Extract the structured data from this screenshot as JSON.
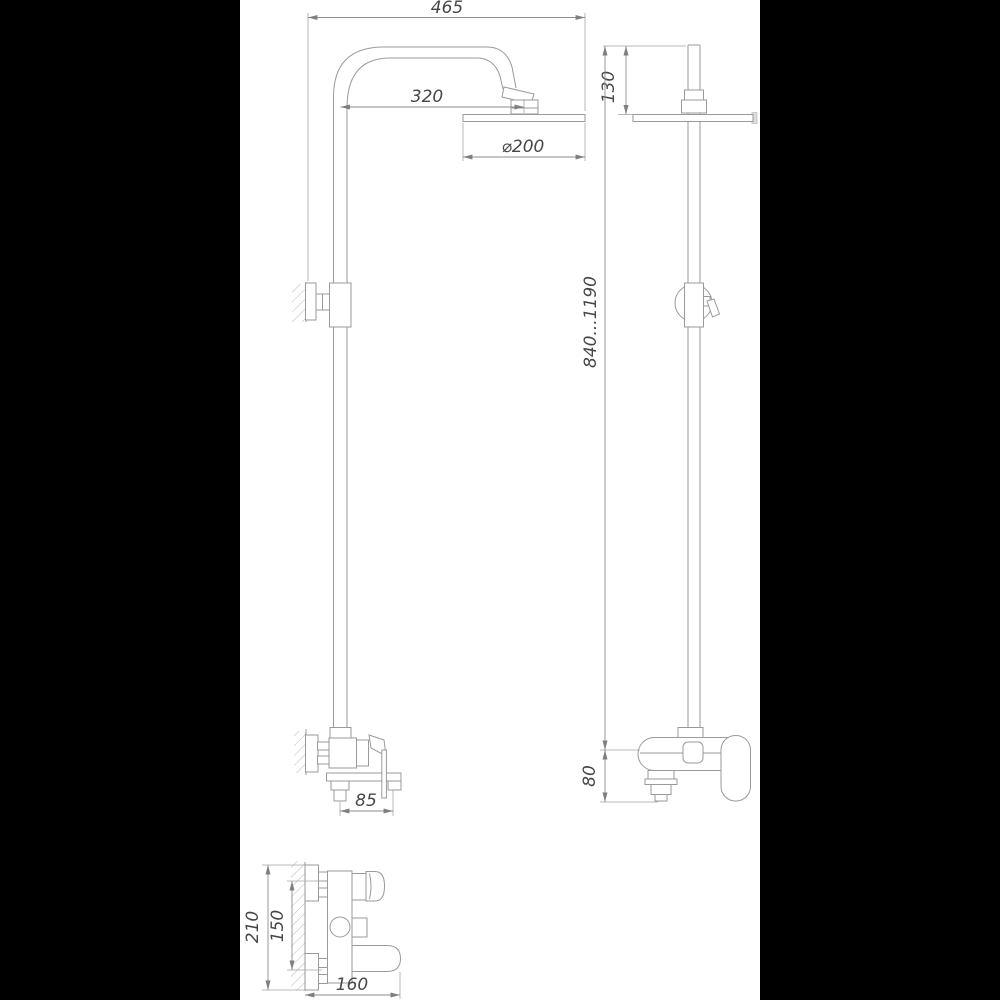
{
  "drawing": {
    "kind": "technical-dimension-drawing",
    "subject": "shower-column-with-rain-head-and-wall-mixer",
    "colors": {
      "line": "#9a9a9a",
      "text": "#474747",
      "sheet_background": "#ffffff",
      "matte_background": "#000000"
    },
    "dims": {
      "d465": "465",
      "d320": "320",
      "d200": "⌀200",
      "d130": "130",
      "d840_1190": "840...1190",
      "d80": "80",
      "d85": "85",
      "d210": "210",
      "d150": "150",
      "d160": "160"
    }
  }
}
